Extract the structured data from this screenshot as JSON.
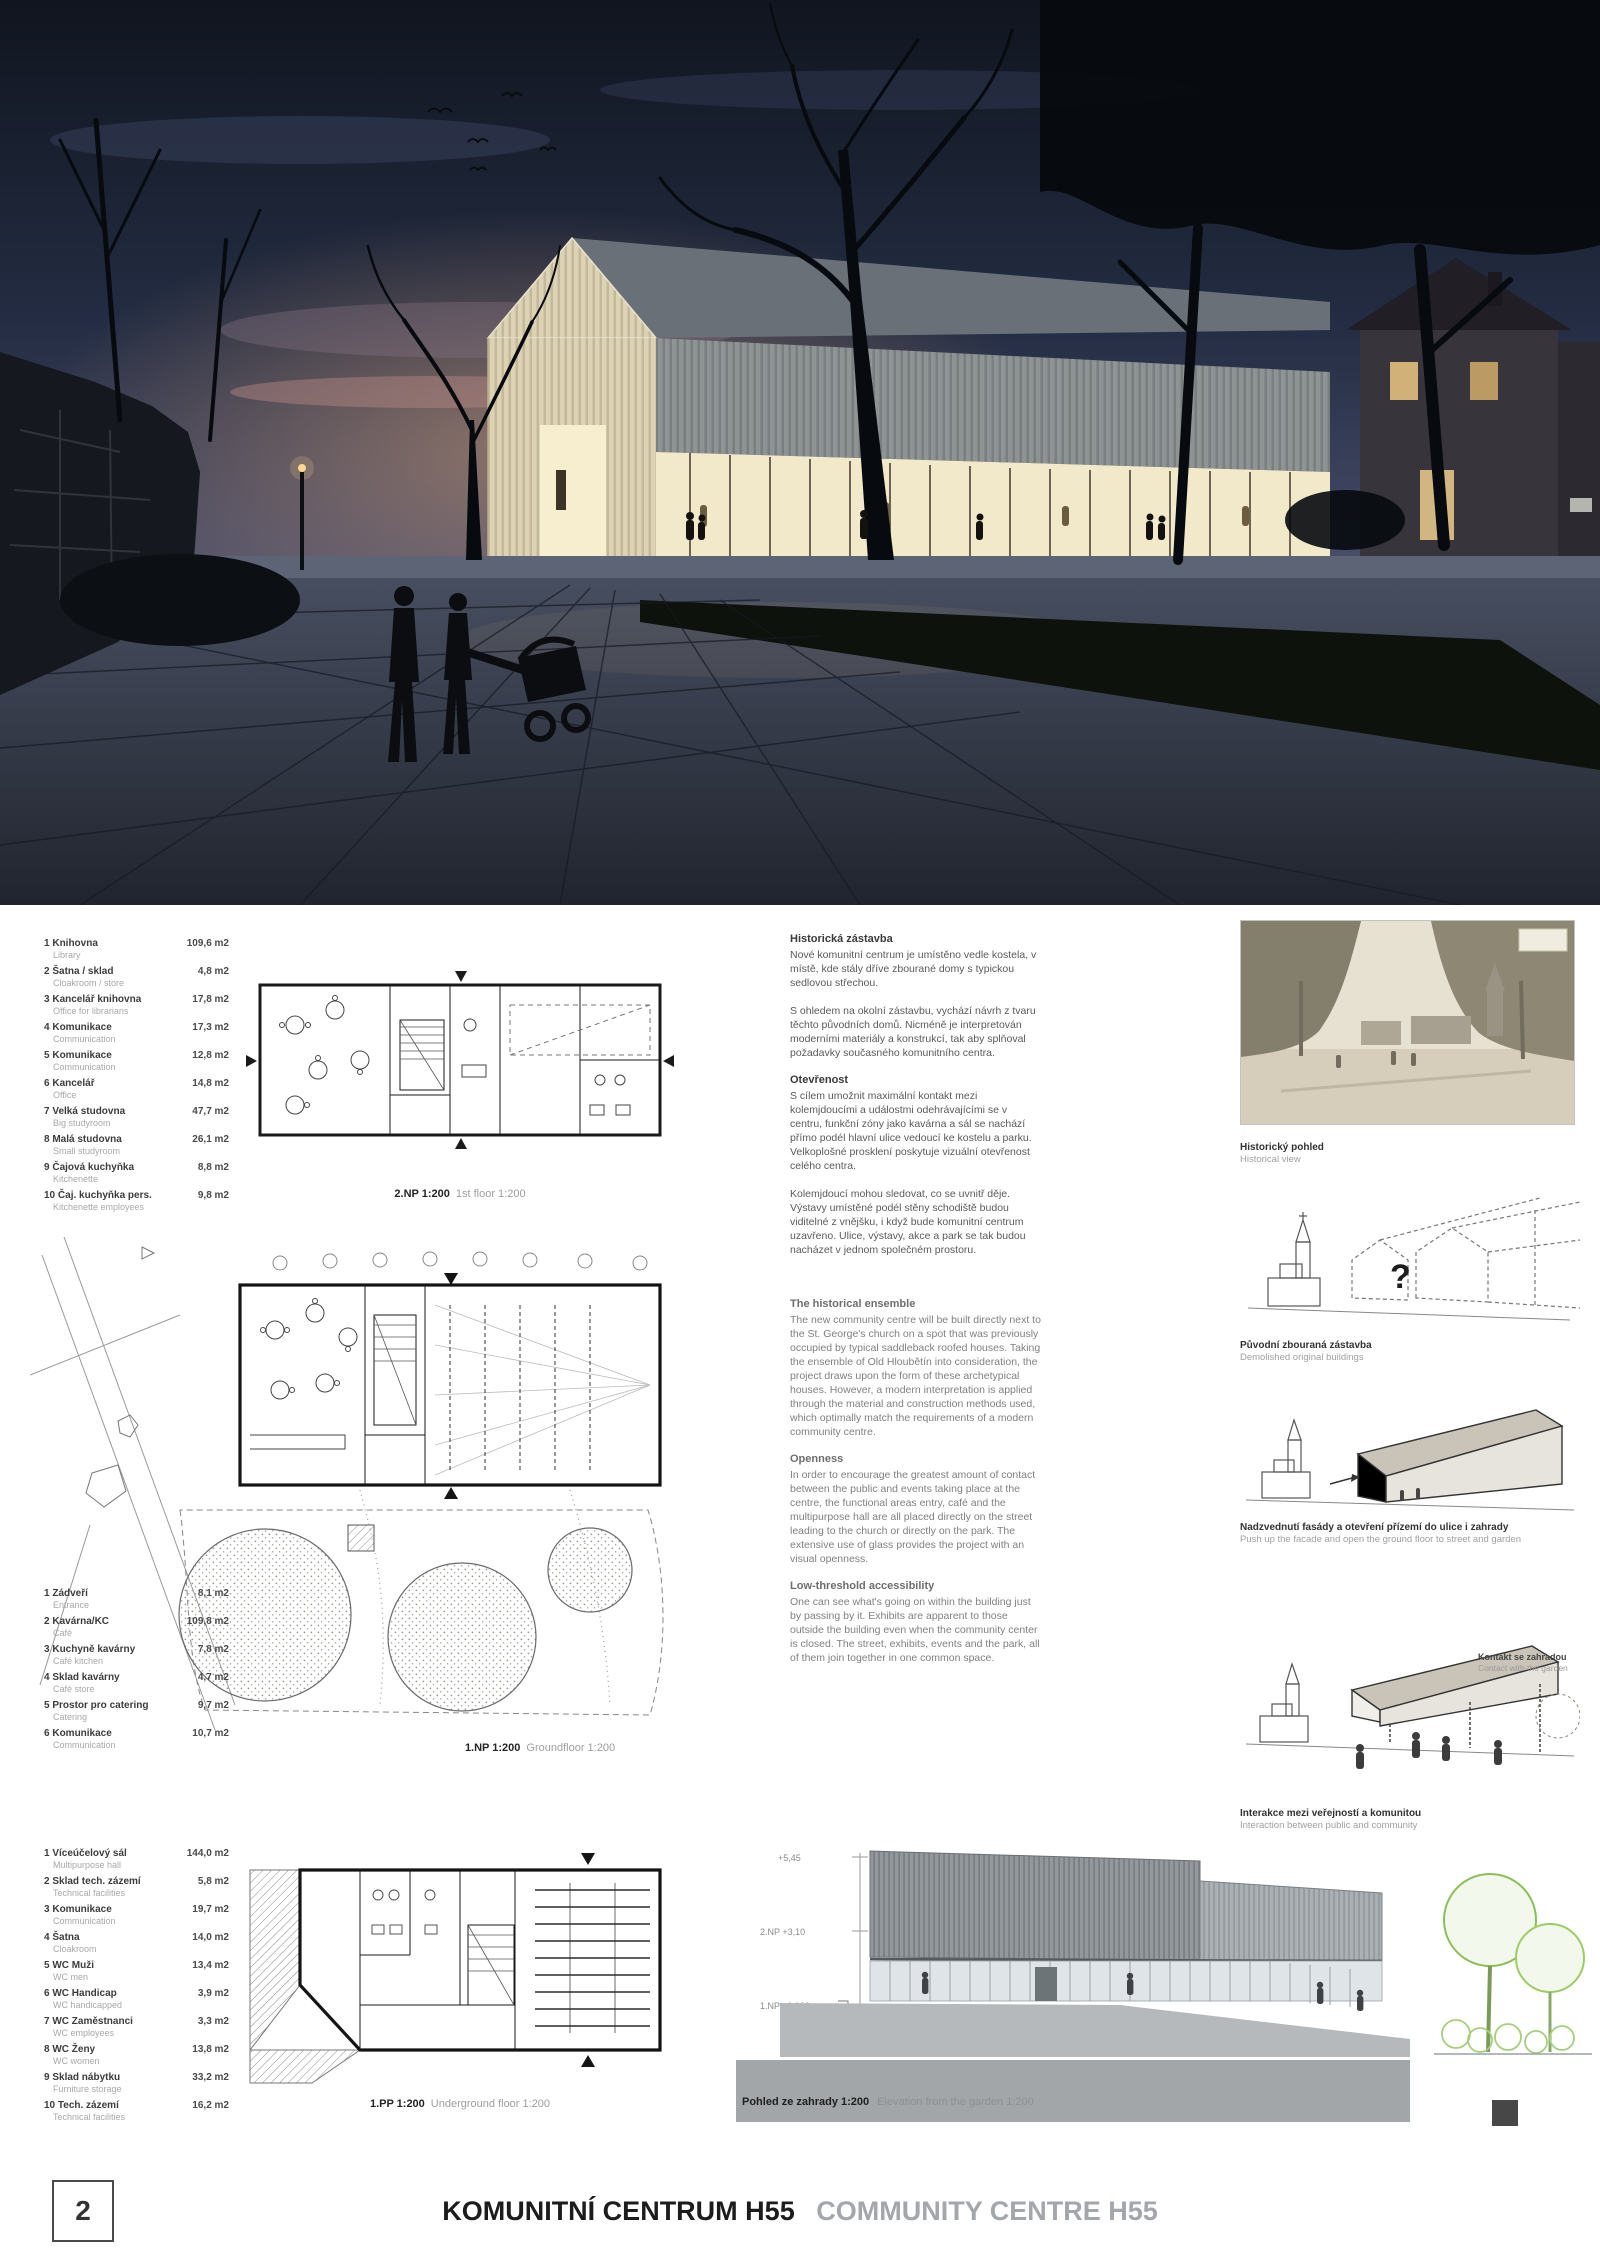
{
  "footer": {
    "page": "2",
    "title_cs": "KOMUNITNÍ CENTRUM H55",
    "title_en": "COMMUNITY CENTRE H55"
  },
  "plans": {
    "floor1_label": {
      "bold": "2.NP 1:200",
      "light": "1st floor 1:200"
    },
    "ground_label": {
      "bold": "1.NP 1:200",
      "light": "Groundfloor 1:200"
    },
    "basement_label": {
      "bold": "1.PP 1:200",
      "light": "Underground floor 1:200"
    },
    "elevation_label": {
      "bold": "Pohled ze zahrady 1:200",
      "light": "Elevation from the garden 1:200"
    },
    "elevation_levels": {
      "top": "+5,45",
      "mid": "2.NP +3,10",
      "base": "1.NP ±0,000"
    }
  },
  "legends": {
    "floor1": {
      "rows": [
        {
          "num": "1",
          "cs": "Knihovna",
          "en": "Library",
          "area": "109,6 m2"
        },
        {
          "num": "2",
          "cs": "Šatna / sklad",
          "en": "Cloakroom / store",
          "area": "4,8 m2"
        },
        {
          "num": "3",
          "cs": "Kancelář knihovna",
          "en": "Office for librarians",
          "area": "17,8 m2"
        },
        {
          "num": "4",
          "cs": "Komunikace",
          "en": "Communication",
          "area": "17,3 m2"
        },
        {
          "num": "5",
          "cs": "Komunikace",
          "en": "Communication",
          "area": "12,8 m2"
        },
        {
          "num": "6",
          "cs": "Kancelář",
          "en": "Office",
          "area": "14,8 m2"
        },
        {
          "num": "7",
          "cs": "Velká studovna",
          "en": "Big studyroom",
          "area": "47,7 m2"
        },
        {
          "num": "8",
          "cs": "Malá studovna",
          "en": "Small studyroom",
          "area": "26,1 m2"
        },
        {
          "num": "9",
          "cs": "Čajová kuchyňka",
          "en": "Kitchenette",
          "area": "8,8 m2"
        },
        {
          "num": "10",
          "cs": "Čaj. kuchyňka pers.",
          "en": "Kitchenette employees",
          "area": "9,8 m2"
        }
      ]
    },
    "ground": {
      "rows": [
        {
          "num": "1",
          "cs": "Zádveří",
          "en": "Entrance",
          "area": "8,1 m2"
        },
        {
          "num": "2",
          "cs": "Kavárna/KC",
          "en": "Café",
          "area": "109,8 m2"
        },
        {
          "num": "3",
          "cs": "Kuchyně kavárny",
          "en": "Café kitchen",
          "area": "7,8 m2"
        },
        {
          "num": "4",
          "cs": "Sklad kavárny",
          "en": "Café store",
          "area": "4,7 m2"
        },
        {
          "num": "5",
          "cs": "Prostor pro catering",
          "en": "Catering",
          "area": "9,7 m2"
        },
        {
          "num": "6",
          "cs": "Komunikace",
          "en": "Communication",
          "area": "10,7 m2"
        }
      ]
    },
    "basement": {
      "rows": [
        {
          "num": "1",
          "cs": "Víceúčelový sál",
          "en": "Multipurpose hall",
          "area": "144,0 m2"
        },
        {
          "num": "2",
          "cs": "Sklad tech. zázemí",
          "en": "Technical facilities",
          "area": "5,8 m2"
        },
        {
          "num": "3",
          "cs": "Komunikace",
          "en": "Communication",
          "area": "19,7 m2"
        },
        {
          "num": "4",
          "cs": "Šatna",
          "en": "Cloakroom",
          "area": "14,0 m2"
        },
        {
          "num": "5",
          "cs": "WC Muži",
          "en": "WC men",
          "area": "13,4 m2"
        },
        {
          "num": "6",
          "cs": "WC Handicap",
          "en": "WC handicapped",
          "area": "3,9 m2"
        },
        {
          "num": "7",
          "cs": "WC Zaměstnanci",
          "en": "WC employees",
          "area": "3,3 m2"
        },
        {
          "num": "8",
          "cs": "WC Ženy",
          "en": "WC women",
          "area": "13,8 m2"
        },
        {
          "num": "9",
          "cs": "Sklad nábytku",
          "en": "Furniture storage",
          "area": "33,2 m2"
        },
        {
          "num": "10",
          "cs": "Tech. zázemí",
          "en": "Technical facilities",
          "area": "16,2 m2"
        }
      ]
    }
  },
  "text_cs": {
    "h1": "Historická zástavba",
    "p1": "Nové komunitní centrum je umístěno vedle kostela, v místě, kde stály dříve zbourané domy s typickou sedlovou střechou.",
    "p2": "S ohledem na okolní zástavbu, vychází návrh z tvaru těchto původních domů. Nicméně je interpretován moderními materiály a konstrukcí, tak aby splňoval požadavky současného komunitního centra.",
    "h2": "Otevřenost",
    "p3": "S cílem umožnit maximální kontakt mezi kolemjdoucími a událostmi odehrávajícími se v centru, funkční zóny jako kavárna a sál se nachází přímo podél hlavní ulice vedoucí ke kostelu a parku. Velkoplošné prosklení poskytuje vizuální otevřenost celého centra.",
    "p4": "Kolemjdoucí mohou sledovat, co se uvnitř děje. Výstavy umístěné podél stěny schodiště budou viditelné z vnějšku, i když bude komunitní centrum uzavřeno. Ulice, výstavy, akce a park se tak budou nacházet v jednom společném prostoru."
  },
  "text_en": {
    "h1": "The historical ensemble",
    "p1": "The new community centre will be built directly next to the St. George's church on a spot that was previously occupied by typical saddleback roofed houses. Taking the ensemble of Old Hloubětín into consideration, the project draws upon the form of these archetypical houses. However, a modern interpretation is applied through the material and construction methods used, which optimally match the requirements of a modern community centre.",
    "h2": "Openness",
    "p2": "In order to encourage the greatest amount of contact between the public and events taking place at the centre, the functional areas entry, café and the multipurpose hall are all placed directly on the street leading to the church or directly on the park. The extensive use of glass provides the project with an visual openness.",
    "h3": "Low-threshold accessibility",
    "p3": "One can see what's going on within the building just by passing by it. Exhibits are apparent to those outside the building even when the community center is closed. The street, exhibits, events and the park, all of them join together in one common space."
  },
  "diagrams": {
    "photo_caption": {
      "cs": "Historický pohled",
      "en": "Historical view"
    },
    "d1": {
      "cs": "Původní zbouraná zástavba",
      "en": "Demolished original buildings",
      "mark": "?"
    },
    "d2": {
      "cs": "Nadzvednutí fasády a otevření přízemí do ulice i zahrady",
      "en": "Push up the facade and open the ground floor to street and garden"
    },
    "d3": {
      "cs": "Interakce mezi veřejností a komunitou",
      "en": "Interaction between public and community",
      "side_cs": "Kontakt se zahradou",
      "side_en": "Contact with the garden"
    }
  },
  "colors": {
    "sky_top": "#10151f",
    "dusk_glow": "#c9a083",
    "facade_glow": "#f2e9cb",
    "plan_line": "#1a1a1a",
    "band_gray": "#a2a6a9",
    "tree_green": "#8bbf55"
  }
}
